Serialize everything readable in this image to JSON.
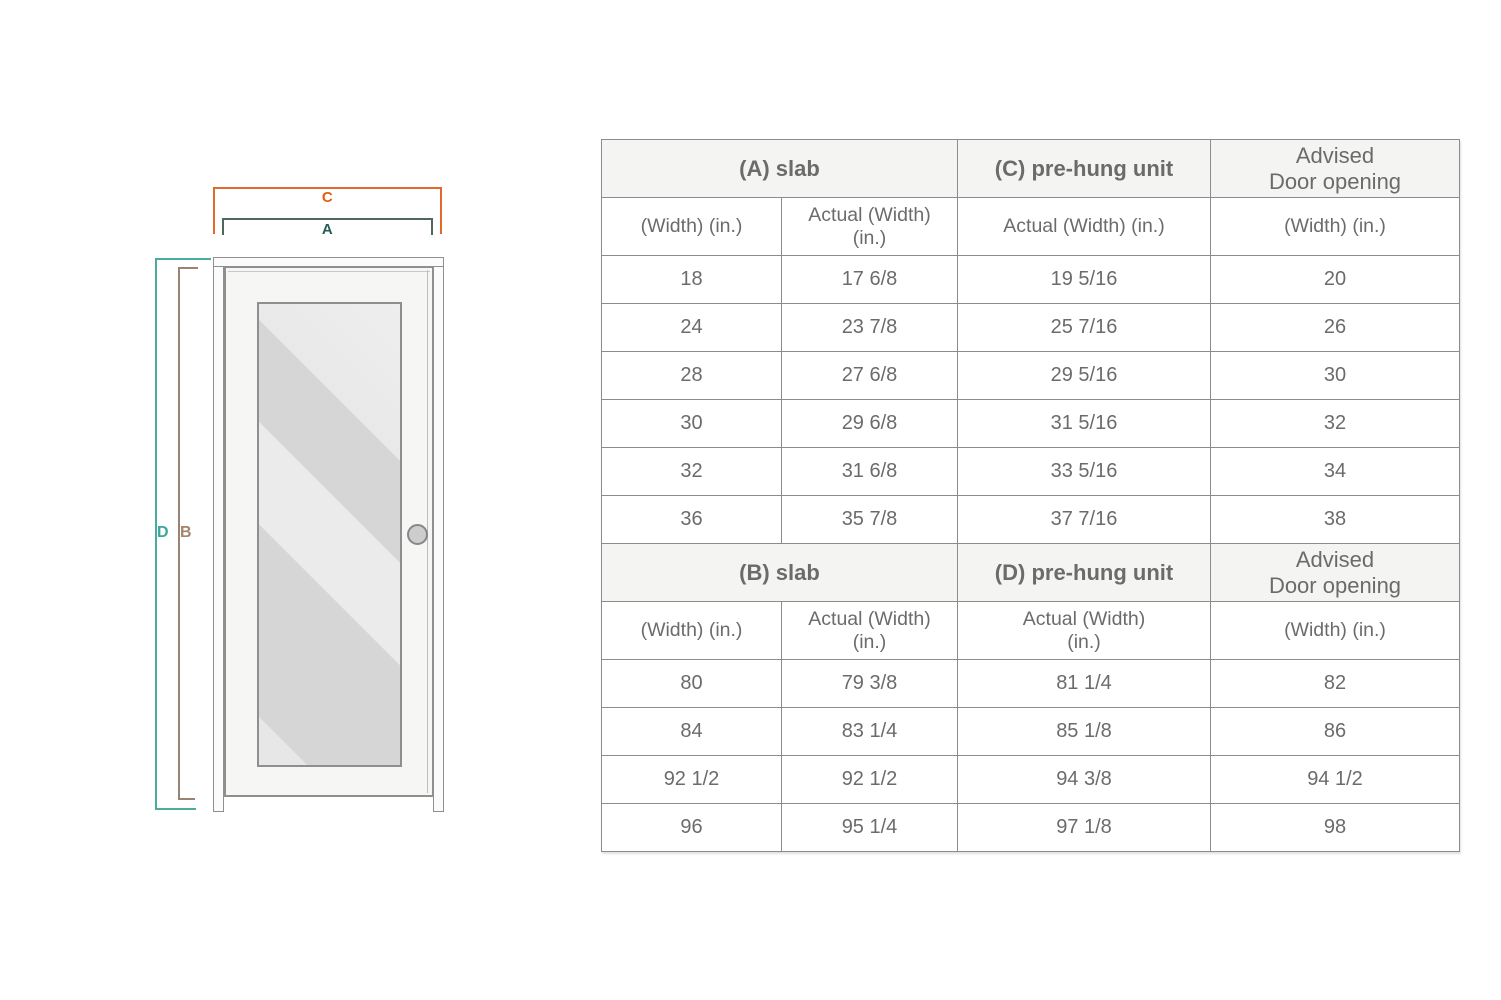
{
  "diagram": {
    "labels": {
      "c": "C",
      "a": "A",
      "d": "D",
      "b": "B"
    },
    "colors": {
      "c_orange": "#E85C0F",
      "a_dark_teal": "#235E54",
      "d_teal": "#3AA79B",
      "b_brown": "#A5846C",
      "glass_gray": "#D6D6D6",
      "frame_gray": "#8F8F8F"
    }
  },
  "table": {
    "header_bg": "#F4F4F2",
    "border_color": "#8C8C8C",
    "text_color": "#6B6B6B",
    "sections": [
      {
        "groups": [
          {
            "label": "(A) slab",
            "color": "#235E54"
          },
          {
            "label": "(C) pre-hung unit",
            "color": "#E85C0F"
          },
          {
            "line1": "Advised",
            "line2": "Door opening"
          }
        ],
        "sub": [
          "(Width) (in.)",
          [
            "Actual (Width)",
            "(in.)"
          ],
          "Actual (Width) (in.)",
          "(Width) (in.)"
        ],
        "rows": [
          [
            "18",
            "17 6/8",
            "19 5/16",
            "20"
          ],
          [
            "24",
            "23 7/8",
            "25 7/16",
            "26"
          ],
          [
            "28",
            "27 6/8",
            "29 5/16",
            "30"
          ],
          [
            "30",
            "29 6/8",
            "31 5/16",
            "32"
          ],
          [
            "32",
            "31 6/8",
            "33 5/16",
            "34"
          ],
          [
            "36",
            "35 7/8",
            "37 7/16",
            "38"
          ]
        ]
      },
      {
        "groups": [
          {
            "label": "(B) slab",
            "color": "#A5846C"
          },
          {
            "label": "(D) pre-hung unit",
            "color": "#3AA79B"
          },
          {
            "line1": "Advised",
            "line2": "Door opening"
          }
        ],
        "sub": [
          "(Width) (in.)",
          [
            "Actual (Width)",
            "(in.)"
          ],
          [
            "Actual (Width)",
            "(in.)"
          ],
          "(Width) (in.)"
        ],
        "rows": [
          [
            "80",
            "79 3/8",
            "81 1/4",
            "82"
          ],
          [
            "84",
            "83 1/4",
            "85 1/8",
            "86"
          ],
          [
            "92 1/2",
            "92 1/2",
            "94 3/8",
            "94 1/2"
          ],
          [
            "96",
            "95 1/4",
            "97 1/8",
            "98"
          ]
        ]
      }
    ]
  },
  "chart_data": {
    "type": "table",
    "title": "Door slab and pre-hung unit size chart",
    "tables": [
      {
        "group_headers": [
          "(A) slab",
          "(C) pre-hung unit",
          "Advised Door opening"
        ],
        "columns": [
          "(Width) (in.)",
          "Actual (Width) (in.)",
          "Actual (Width) (in.)",
          "(Width) (in.)"
        ],
        "rows": [
          [
            "18",
            "17 6/8",
            "19 5/16",
            "20"
          ],
          [
            "24",
            "23 7/8",
            "25 7/16",
            "26"
          ],
          [
            "28",
            "27 6/8",
            "29 5/16",
            "30"
          ],
          [
            "30",
            "29 6/8",
            "31 5/16",
            "32"
          ],
          [
            "32",
            "31 6/8",
            "33 5/16",
            "34"
          ],
          [
            "36",
            "35 7/8",
            "37 7/16",
            "38"
          ]
        ]
      },
      {
        "group_headers": [
          "(B) slab",
          "(D) pre-hung unit",
          "Advised Door opening"
        ],
        "columns": [
          "(Width) (in.)",
          "Actual (Width) (in.)",
          "Actual (Width) (in.)",
          "(Width) (in.)"
        ],
        "rows": [
          [
            "80",
            "79 3/8",
            "81 1/4",
            "82"
          ],
          [
            "84",
            "83 1/4",
            "85 1/8",
            "86"
          ],
          [
            "92 1/2",
            "92 1/2",
            "94 3/8",
            "94 1/2"
          ],
          [
            "96",
            "95 1/4",
            "97 1/8",
            "98"
          ]
        ]
      }
    ]
  }
}
